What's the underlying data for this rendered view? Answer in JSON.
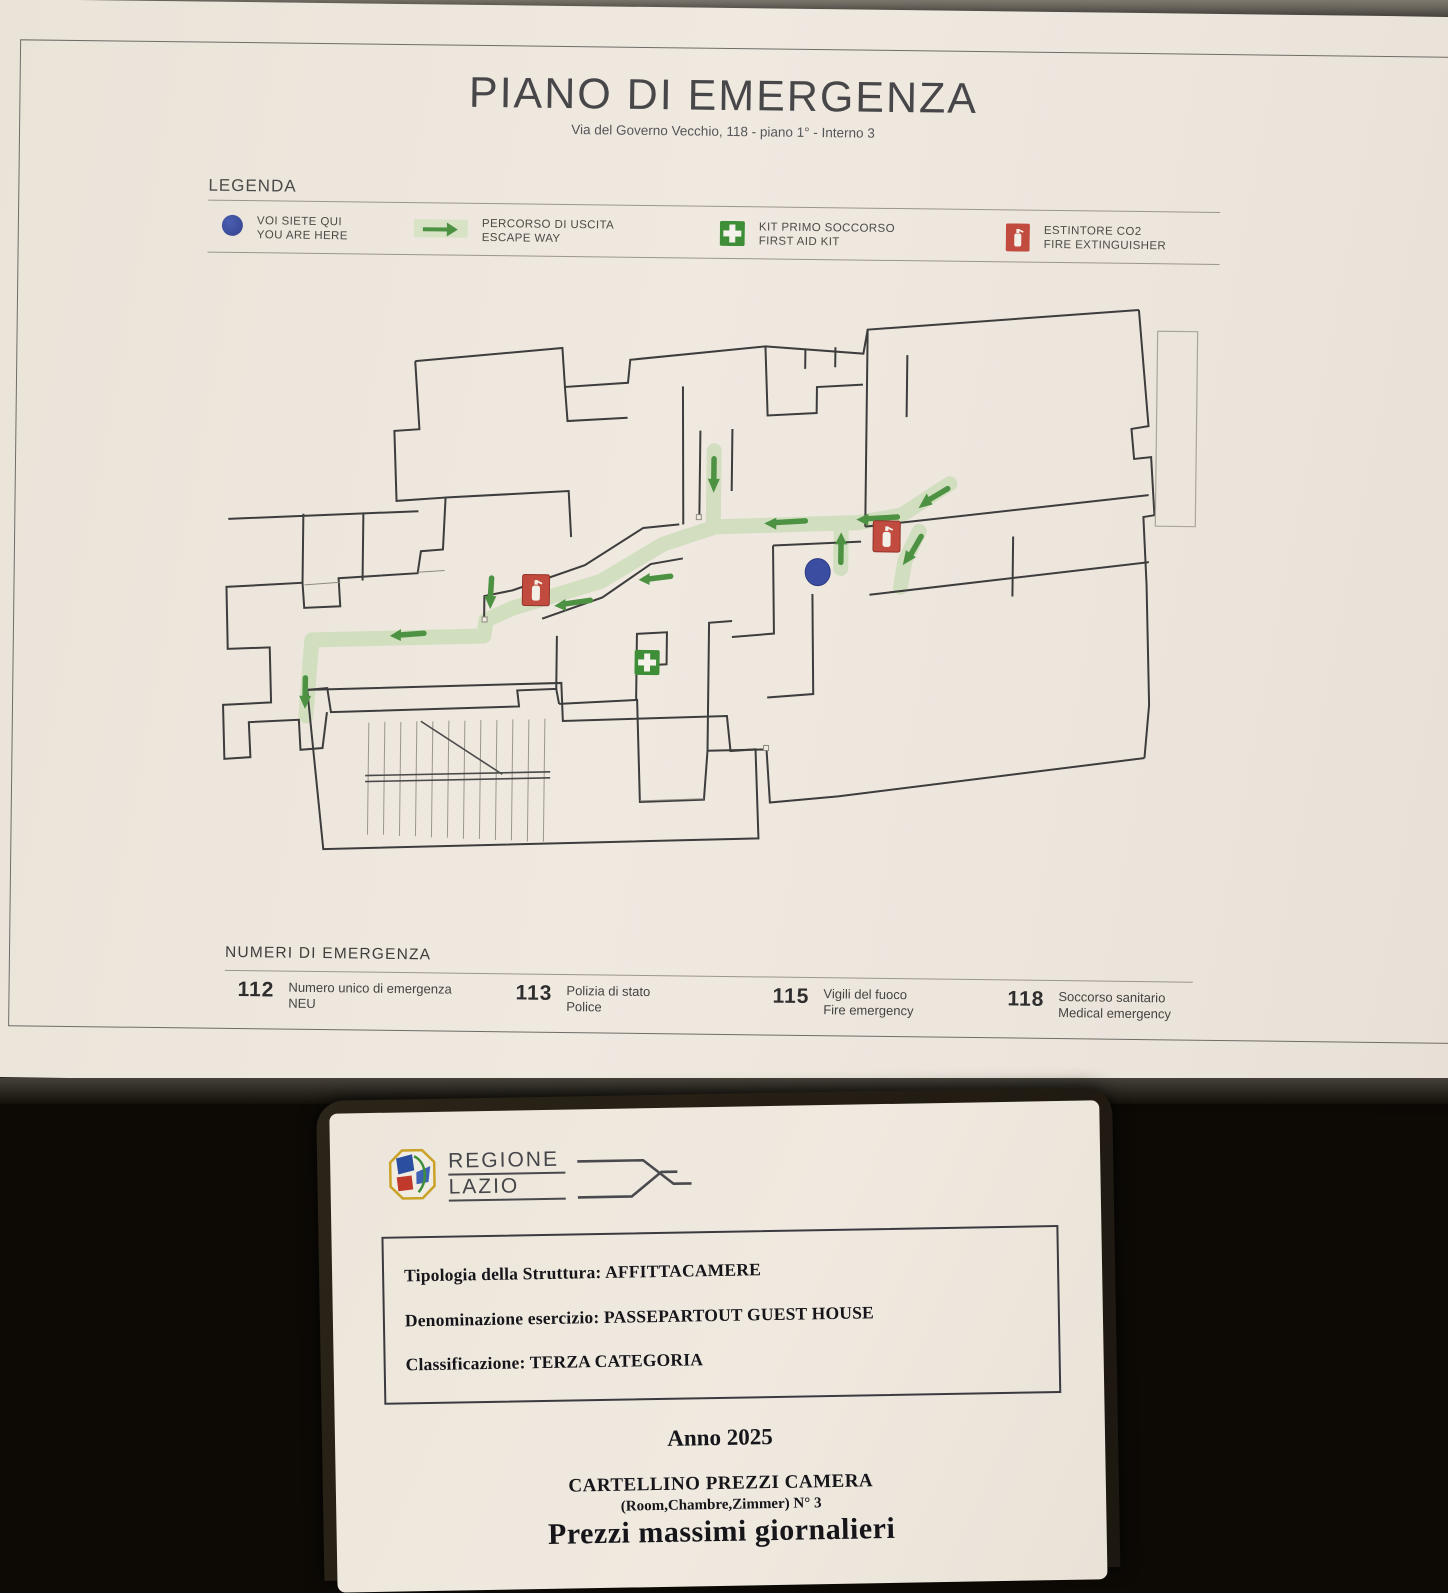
{
  "poster": {
    "title": "PIANO DI EMERGENZA",
    "subtitle": "Via del Governo Vecchio, 118 - piano 1° - Interno 3",
    "legend": {
      "heading": "LEGENDA",
      "items": [
        {
          "icon": "you-are-here-dot",
          "label1": "VOI SIETE QUI",
          "label2": "YOU ARE HERE"
        },
        {
          "icon": "escape-way-arrow",
          "label1": "PERCORSO DI USCITA",
          "label2": "ESCAPE WAY"
        },
        {
          "icon": "first-aid-cross",
          "label1": "KIT PRIMO SOCCORSO",
          "label2": "FIRST AID KIT"
        },
        {
          "icon": "fire-extinguisher",
          "label1": "ESTINTORE CO2",
          "label2": "FIRE EXTINGUISHER"
        }
      ]
    },
    "emergency_numbers": {
      "heading": "NUMERI  DI EMERGENZA",
      "items": [
        {
          "number": "112",
          "label1": "Numero unico di emergenza",
          "label2": "NEU"
        },
        {
          "number": "113",
          "label1": "Polizia di stato",
          "label2": "Police"
        },
        {
          "number": "115",
          "label1": "Vigili del fuoco",
          "label2": "Fire emergency"
        },
        {
          "number": "118",
          "label1": "Soccorso sanitario",
          "label2": "Medical emergency"
        }
      ]
    },
    "colors": {
      "escape_route": "#cdddba",
      "escape_arrow": "#4d9243",
      "you_are_here": "#3a4da0",
      "extinguisher_red": "#c14b3e",
      "first_aid_green": "#3e8e37"
    }
  },
  "price_card": {
    "logo": {
      "line1": "REGIONE",
      "line2": "LAZIO"
    },
    "info_box": {
      "line1": "Tipologia della Struttura: AFFITTACAMERE",
      "line2": "Denominazione esercizio: PASSEPARTOUT GUEST HOUSE",
      "line3": "Classificazione: TERZA CATEGORIA"
    },
    "year": "Anno 2025",
    "card_title": "CARTELLINO PREZZI CAMERA",
    "card_subtitle": "(Room,Chambre,Zimmer)  N° 3",
    "price_heading": "Prezzi massimi giornalieri"
  }
}
